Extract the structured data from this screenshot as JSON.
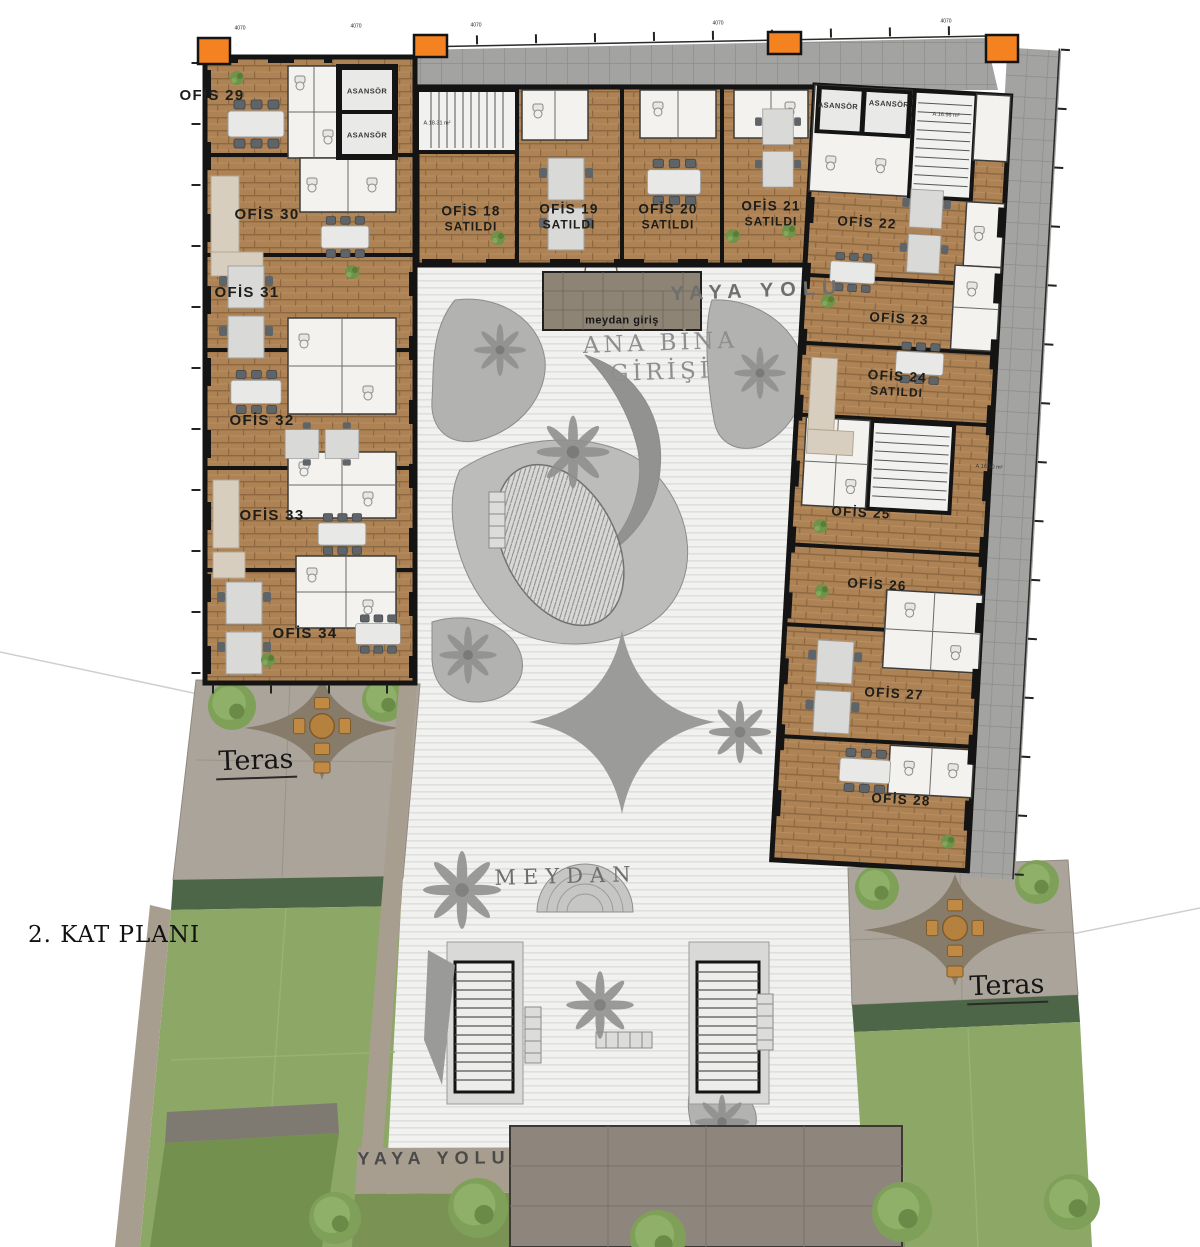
{
  "plan_title": "2. KAT PLANI",
  "labels": {
    "meydan": "MEYDAN",
    "ana_bina_girisi": [
      "ANA BİNA",
      "GİRİŞİ"
    ],
    "meydan_giris": "meydan giriş",
    "yaya_yolu_top": "YAYA YOLU",
    "yaya_yolu_bottom": "YAYA YOLU",
    "teras_left": "Teras",
    "teras_right": "Teras",
    "elevator": "ASANSÖR"
  },
  "offices": [
    {
      "name": "OFİS 18",
      "status": "SATILDI"
    },
    {
      "name": "OFİS 19",
      "status": "SATILDI"
    },
    {
      "name": "OFİS 20",
      "status": "SATILDI"
    },
    {
      "name": "OFİS 21",
      "status": "SATILDI"
    },
    {
      "name": "OFİS 22",
      "status": ""
    },
    {
      "name": "OFİS 23",
      "status": ""
    },
    {
      "name": "OFİS 24",
      "status": "SATILDI"
    },
    {
      "name": "OFİS 25",
      "status": ""
    },
    {
      "name": "OFİS 26",
      "status": ""
    },
    {
      "name": "OFİS 27",
      "status": ""
    },
    {
      "name": "OFİS 28",
      "status": ""
    },
    {
      "name": "OFİS 29",
      "status": ""
    },
    {
      "name": "OFİS 30",
      "status": ""
    },
    {
      "name": "OFİS 31",
      "status": ""
    },
    {
      "name": "OFİS 32",
      "status": ""
    },
    {
      "name": "OFİS 33",
      "status": ""
    },
    {
      "name": "OFİS 34",
      "status": ""
    }
  ],
  "stair_areas": [
    "A.18.31 m²",
    "A.16.96 m²",
    "A.16.50 m²"
  ],
  "dimension_label": "4070",
  "colors": {
    "accent_orange": "#F58220",
    "wood_floor": "#AB8052",
    "terrace_tile": "#A3A3A1",
    "lawn_green": "#8CA766",
    "hedge_green": "#4D6647",
    "canopy_taupe": "#877B6A",
    "wall_black": "#141414",
    "paving_light": "#F1F1F0"
  }
}
